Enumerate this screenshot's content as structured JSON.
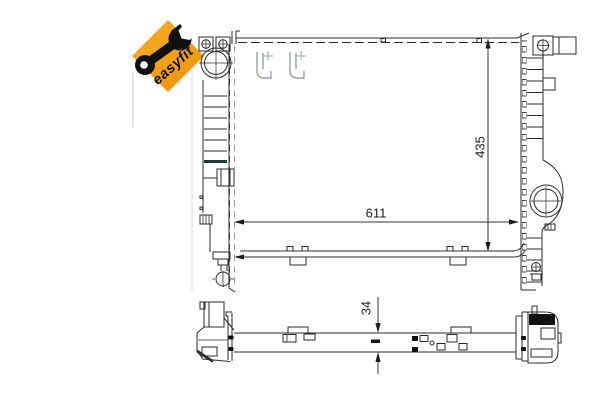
{
  "badge": {
    "label": "easyfit",
    "background_color": "#F2A312",
    "icon": "wrench-icon",
    "text_color": "#101010"
  },
  "dimensions": {
    "width": "611",
    "height": "435",
    "depth": "34"
  },
  "drawing": {
    "subject": "radiator technical drawing",
    "line_color": "#2b2b2b",
    "ghost_hardware_color": "#98a2a8",
    "dark_fin_color": "#1d3a38"
  }
}
